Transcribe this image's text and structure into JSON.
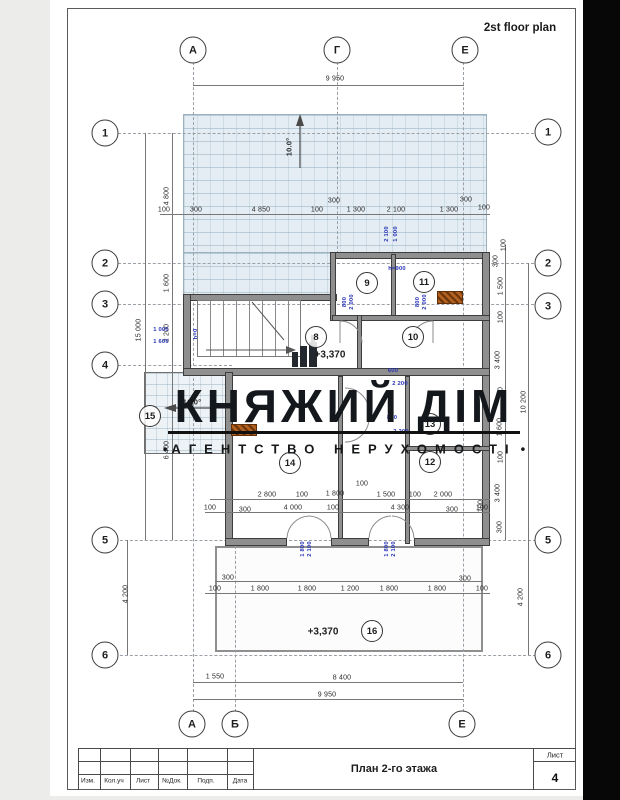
{
  "page": {
    "plan_title": "2st floor plan"
  },
  "watermark": {
    "title": "КНЯЖИЙ ДІМ",
    "subtitle": "АГЕНТСТВО НЕРУХОМОСТІ",
    "bullet": "•"
  },
  "titleblock": {
    "drawing_name": "План 2-го этажа",
    "sheet_label": "Лист",
    "sheet_number": "4",
    "columns": [
      "Изм.",
      "Кол.уч",
      "Лист",
      "№Док.",
      "Подп.",
      "Дата"
    ]
  },
  "colors": {
    "dim_blue": "#2633b6",
    "duct_orange": "#b2601f",
    "terrace_fill": "#e3edf3"
  },
  "axis_circles": [
    {
      "l": "А",
      "x": 193,
      "y": 50
    },
    {
      "l": "Г",
      "x": 337,
      "y": 50
    },
    {
      "l": "Е",
      "x": 465,
      "y": 50
    },
    {
      "l": "А",
      "x": 192,
      "y": 724
    },
    {
      "l": "Б",
      "x": 235,
      "y": 724
    },
    {
      "l": "Е",
      "x": 462,
      "y": 724
    },
    {
      "l": "1",
      "x": 105,
      "y": 133
    },
    {
      "l": "2",
      "x": 105,
      "y": 263
    },
    {
      "l": "3",
      "x": 105,
      "y": 304
    },
    {
      "l": "4",
      "x": 105,
      "y": 365
    },
    {
      "l": "5",
      "x": 105,
      "y": 540
    },
    {
      "l": "6",
      "x": 105,
      "y": 655
    },
    {
      "l": "1",
      "x": 548,
      "y": 132
    },
    {
      "l": "2",
      "x": 548,
      "y": 263
    },
    {
      "l": "3",
      "x": 548,
      "y": 306
    },
    {
      "l": "5",
      "x": 548,
      "y": 540
    },
    {
      "l": "6",
      "x": 548,
      "y": 655
    }
  ],
  "rooms": [
    {
      "n": "8",
      "x": 316,
      "y": 337
    },
    {
      "n": "9",
      "x": 367,
      "y": 283
    },
    {
      "n": "10",
      "x": 413,
      "y": 337
    },
    {
      "n": "11",
      "x": 424,
      "y": 282
    },
    {
      "n": "12",
      "x": 430,
      "y": 462
    },
    {
      "n": "13",
      "x": 430,
      "y": 424
    },
    {
      "n": "14",
      "x": 290,
      "y": 463
    },
    {
      "n": "15",
      "x": 150,
      "y": 416
    },
    {
      "n": "16",
      "x": 372,
      "y": 631
    }
  ],
  "levels": [
    {
      "t": "+3,370",
      "x": 330,
      "y": 355
    },
    {
      "t": "+3,370",
      "x": 323,
      "y": 632
    }
  ],
  "slopes": [
    {
      "t": "10.0°",
      "x": 289,
      "y": 147,
      "r": 1
    },
    {
      "t": "10.0°",
      "x": 192,
      "y": 402
    }
  ],
  "dims": [
    {
      "t": "9 950",
      "x": 335,
      "y": 79
    },
    {
      "t": "4 800",
      "x": 167,
      "y": 196,
      "r": 1
    },
    {
      "t": "100",
      "x": 164,
      "y": 210
    },
    {
      "t": "300",
      "x": 196,
      "y": 210
    },
    {
      "t": "4 850",
      "x": 261,
      "y": 210
    },
    {
      "t": "100",
      "x": 317,
      "y": 210
    },
    {
      "t": "300",
      "x": 334,
      "y": 201
    },
    {
      "t": "1 300",
      "x": 356,
      "y": 210
    },
    {
      "t": "2 100",
      "x": 396,
      "y": 210
    },
    {
      "t": "1 300",
      "x": 449,
      "y": 210
    },
    {
      "t": "300",
      "x": 466,
      "y": 200
    },
    {
      "t": "100",
      "x": 484,
      "y": 208
    },
    {
      "t": "2 100",
      "x": 387,
      "y": 234,
      "r": 1,
      "b": 1
    },
    {
      "t": "1 000",
      "x": 396,
      "y": 234,
      "r": 1,
      "b": 1
    },
    {
      "t": "h=900",
      "x": 397,
      "y": 269,
      "b": 1
    },
    {
      "t": "100",
      "x": 504,
      "y": 245,
      "r": 1
    },
    {
      "t": "300",
      "x": 496,
      "y": 261,
      "r": 1
    },
    {
      "t": "1 500",
      "x": 501,
      "y": 286,
      "r": 1
    },
    {
      "t": "100",
      "x": 501,
      "y": 317,
      "r": 1
    },
    {
      "t": "3 400",
      "x": 498,
      "y": 360,
      "r": 1
    },
    {
      "t": "100",
      "x": 501,
      "y": 393,
      "r": 1
    },
    {
      "t": "1 600",
      "x": 500,
      "y": 427,
      "r": 1
    },
    {
      "t": "100",
      "x": 501,
      "y": 457,
      "r": 1
    },
    {
      "t": "3 400",
      "x": 498,
      "y": 493,
      "r": 1
    },
    {
      "t": "300",
      "x": 500,
      "y": 527,
      "r": 1
    },
    {
      "t": "10 200",
      "x": 524,
      "y": 402,
      "r": 1
    },
    {
      "t": "100",
      "x": 481,
      "y": 506,
      "r": 1
    },
    {
      "t": "4 200",
      "x": 521,
      "y": 597,
      "r": 1
    },
    {
      "t": "15 000",
      "x": 139,
      "y": 330,
      "r": 1
    },
    {
      "t": "1 600",
      "x": 167,
      "y": 283,
      "r": 1
    },
    {
      "t": "2 200",
      "x": 167,
      "y": 333,
      "r": 1
    },
    {
      "t": "6 400",
      "x": 167,
      "y": 450,
      "r": 1
    },
    {
      "t": "4 200",
      "x": 126,
      "y": 594,
      "r": 1
    },
    {
      "t": "1 000",
      "x": 161,
      "y": 330,
      "b": 1
    },
    {
      "t": "1 600",
      "x": 161,
      "y": 342,
      "b": 1
    },
    {
      "t": "h=0",
      "x": 196,
      "y": 334,
      "r": 1,
      "b": 1
    },
    {
      "t": "800",
      "x": 345,
      "y": 302,
      "r": 1,
      "b": 1
    },
    {
      "t": "2 000",
      "x": 352,
      "y": 302,
      "r": 1,
      "b": 1
    },
    {
      "t": "800",
      "x": 418,
      "y": 302,
      "r": 1,
      "b": 1
    },
    {
      "t": "2 000",
      "x": 425,
      "y": 302,
      "r": 1,
      "b": 1
    },
    {
      "t": "600",
      "x": 393,
      "y": 371,
      "b": 1
    },
    {
      "t": "2 200",
      "x": 400,
      "y": 384,
      "b": 1
    },
    {
      "t": "800",
      "x": 392,
      "y": 418,
      "b": 1
    },
    {
      "t": "2 200",
      "x": 401,
      "y": 432,
      "b": 1
    },
    {
      "t": "100",
      "x": 362,
      "y": 484
    },
    {
      "t": "2 800",
      "x": 267,
      "y": 495
    },
    {
      "t": "100",
      "x": 302,
      "y": 495
    },
    {
      "t": "1 800",
      "x": 335,
      "y": 494
    },
    {
      "t": "1 500",
      "x": 386,
      "y": 495
    },
    {
      "t": "100",
      "x": 415,
      "y": 495
    },
    {
      "t": "2 000",
      "x": 443,
      "y": 495
    },
    {
      "t": "100",
      "x": 210,
      "y": 508
    },
    {
      "t": "300",
      "x": 245,
      "y": 510
    },
    {
      "t": "4 000",
      "x": 293,
      "y": 508
    },
    {
      "t": "100",
      "x": 333,
      "y": 508
    },
    {
      "t": "4 300",
      "x": 400,
      "y": 508
    },
    {
      "t": "300",
      "x": 452,
      "y": 510
    },
    {
      "t": "100",
      "x": 482,
      "y": 508
    },
    {
      "t": "1 800",
      "x": 303,
      "y": 549,
      "r": 1,
      "b": 1
    },
    {
      "t": "2 100",
      "x": 310,
      "y": 549,
      "r": 1,
      "b": 1
    },
    {
      "t": "1 800",
      "x": 387,
      "y": 549,
      "r": 1,
      "b": 1
    },
    {
      "t": "2 100",
      "x": 394,
      "y": 549,
      "r": 1,
      "b": 1
    },
    {
      "t": "300",
      "x": 228,
      "y": 578
    },
    {
      "t": "300",
      "x": 465,
      "y": 579
    },
    {
      "t": "100",
      "x": 215,
      "y": 589
    },
    {
      "t": "1 800",
      "x": 260,
      "y": 589
    },
    {
      "t": "1 800",
      "x": 307,
      "y": 589
    },
    {
      "t": "1 200",
      "x": 350,
      "y": 589
    },
    {
      "t": "1 800",
      "x": 389,
      "y": 589
    },
    {
      "t": "1 800",
      "x": 437,
      "y": 589
    },
    {
      "t": "100",
      "x": 482,
      "y": 589
    },
    {
      "t": "1 550",
      "x": 215,
      "y": 677
    },
    {
      "t": "8 400",
      "x": 342,
      "y": 678
    },
    {
      "t": "9 950",
      "x": 327,
      "y": 695
    }
  ]
}
